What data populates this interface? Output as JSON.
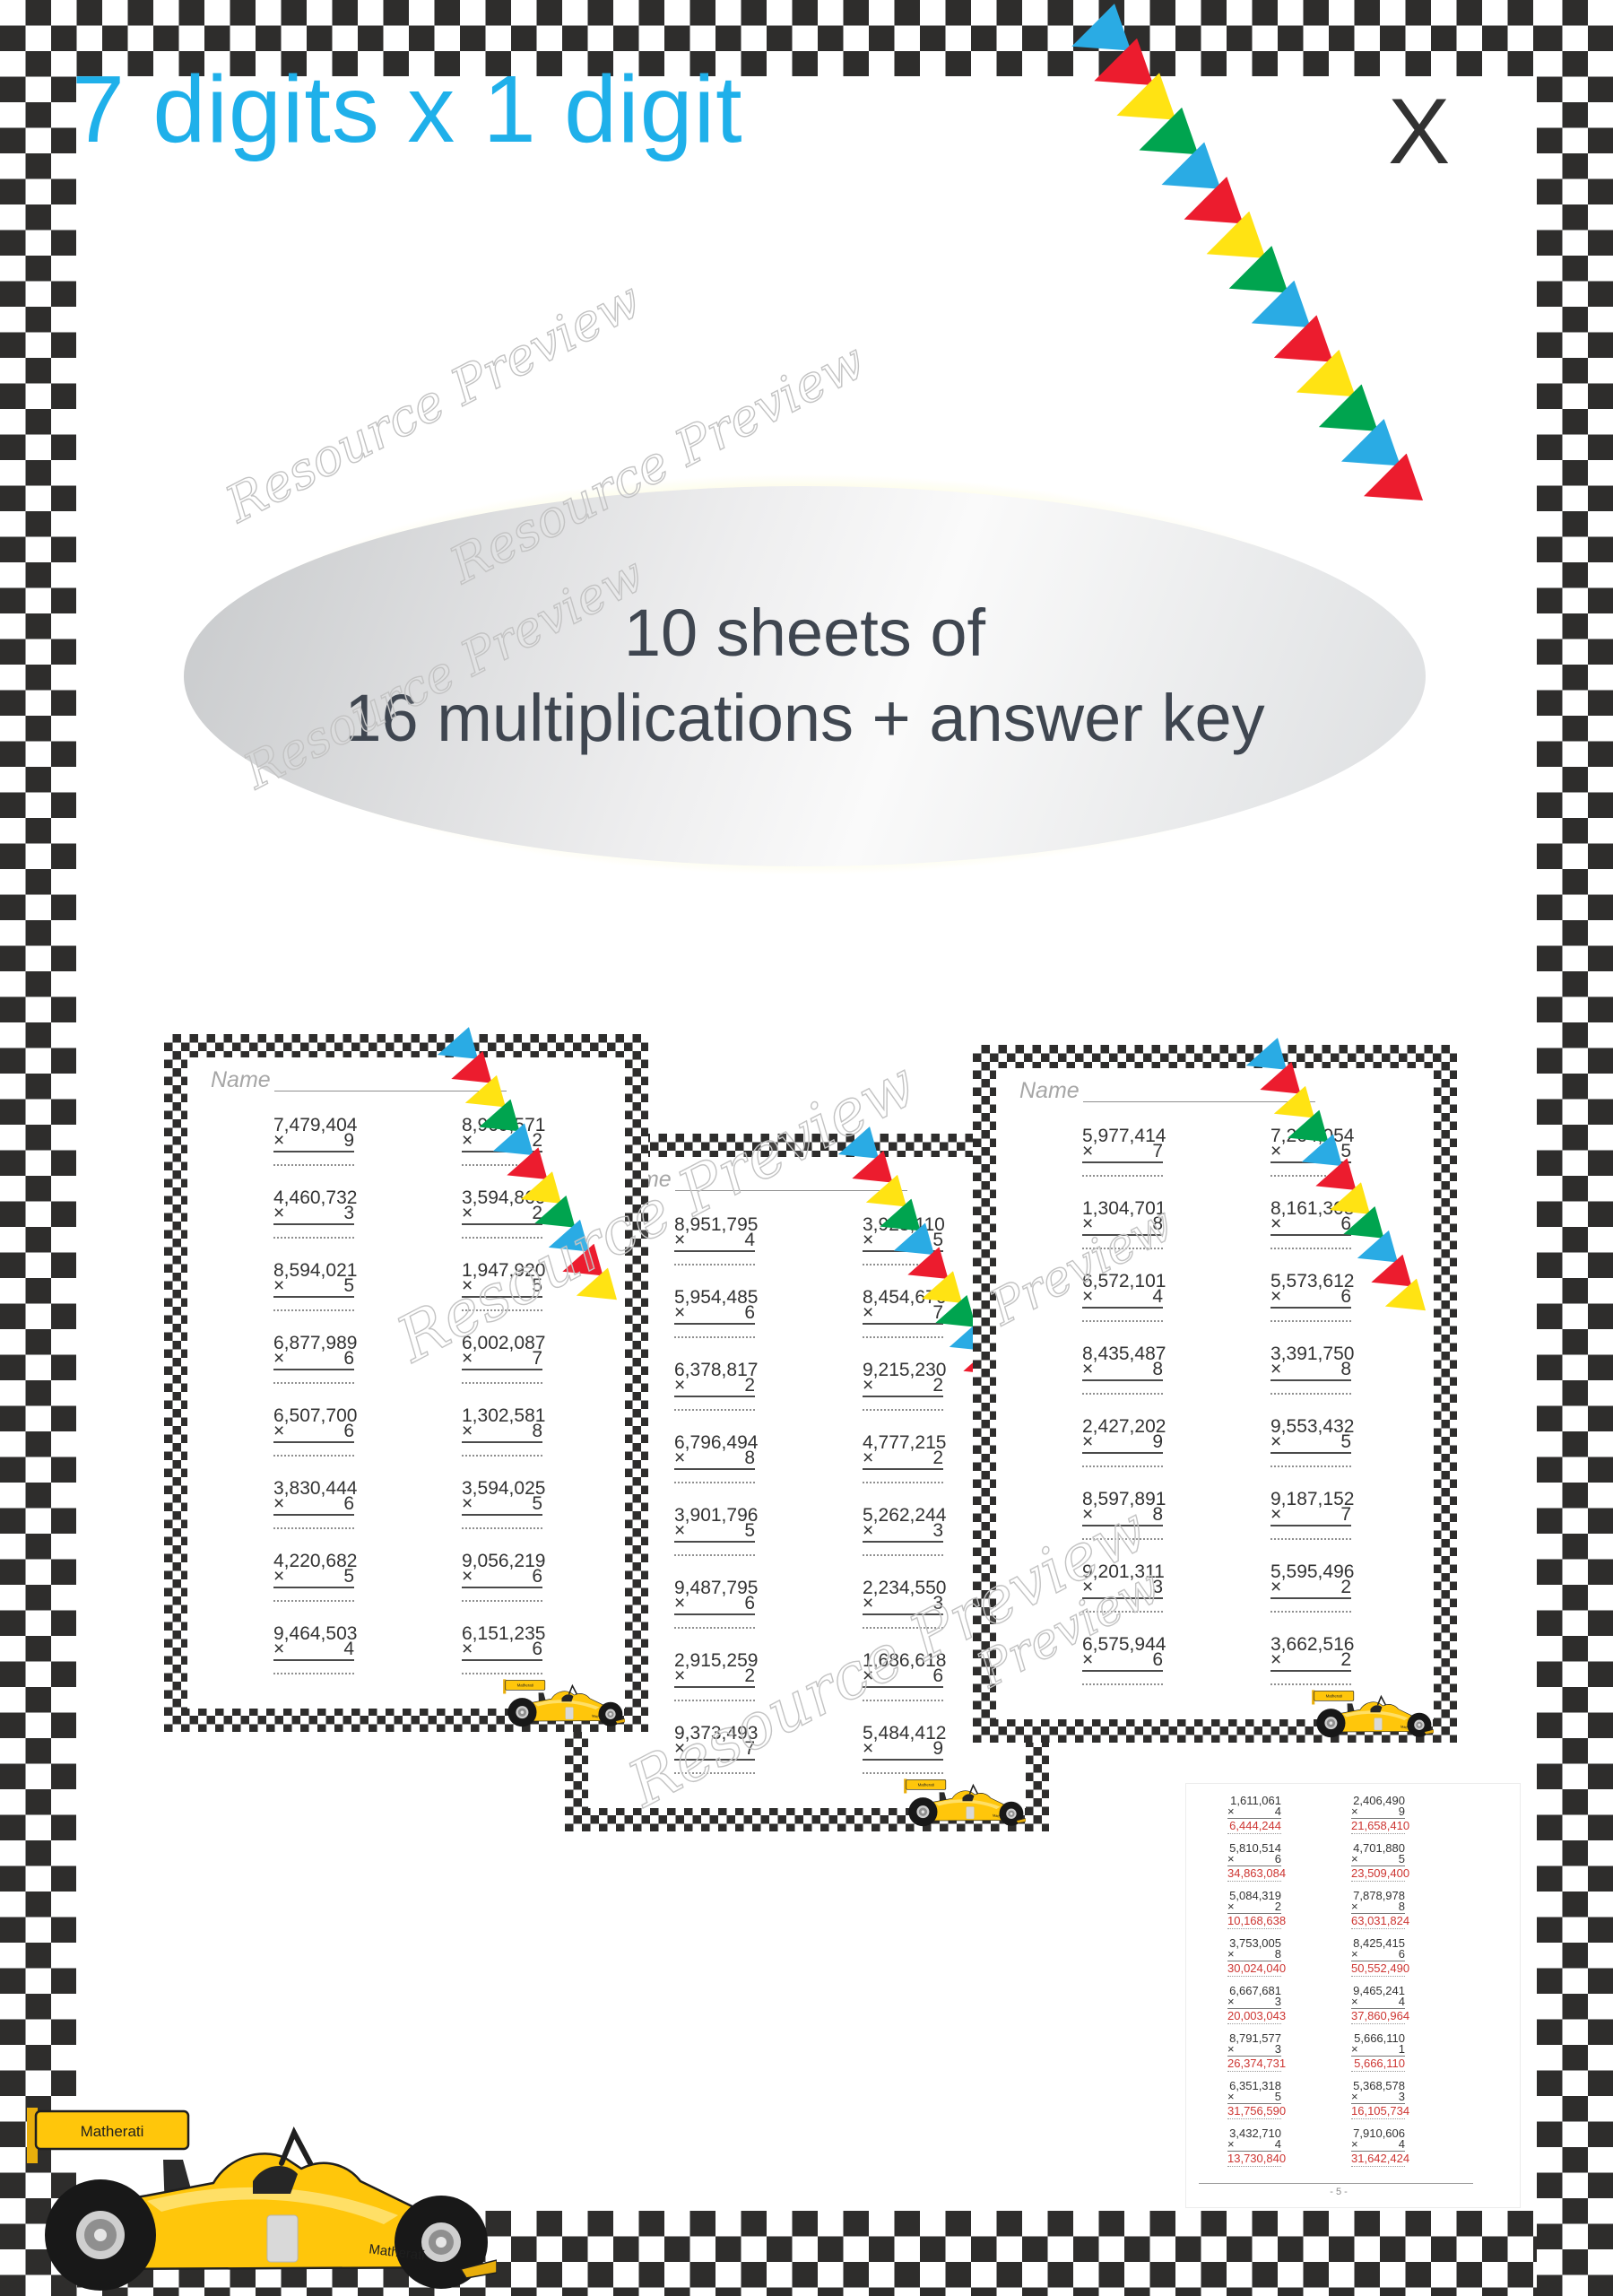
{
  "page": {
    "title": "7 digits x 1 digit",
    "corner_letter": "X",
    "badge": {
      "line1": "10 sheets of",
      "line2": "16 multiplications + answer key"
    },
    "watermark": "Resource Preview",
    "watermark_short": "Preview",
    "name_label": "Name",
    "brand": "Matherati",
    "multiply_sign": "×"
  },
  "colors": {
    "accent_cyan": "#1fb0ea",
    "checker_dark": "#2e2d2c",
    "answer_red": "#cd3531",
    "glow_yellow": "#f5ec66",
    "car_yellow": "#ffc60b",
    "flag_colors": [
      "#2aabe4",
      "#ec1c2e",
      "#ffe313",
      "#00a44f"
    ]
  },
  "sheets": [
    {
      "problems": [
        {
          "n": "7,479,404",
          "m": "9"
        },
        {
          "n": "8,969,571",
          "m": "2"
        },
        {
          "n": "4,460,732",
          "m": "3"
        },
        {
          "n": "3,594,860",
          "m": "2"
        },
        {
          "n": "8,594,021",
          "m": "5"
        },
        {
          "n": "1,947,920",
          "m": "5"
        },
        {
          "n": "6,877,989",
          "m": "6"
        },
        {
          "n": "6,002,087",
          "m": "7"
        },
        {
          "n": "6,507,700",
          "m": "6"
        },
        {
          "n": "1,302,581",
          "m": "8"
        },
        {
          "n": "3,830,444",
          "m": "6"
        },
        {
          "n": "3,594,025",
          "m": "5"
        },
        {
          "n": "4,220,682",
          "m": "5"
        },
        {
          "n": "9,056,219",
          "m": "6"
        },
        {
          "n": "9,464,503",
          "m": "4"
        },
        {
          "n": "6,151,235",
          "m": "6"
        }
      ]
    },
    {
      "problems": [
        {
          "n": "8,951,795",
          "m": "4"
        },
        {
          "n": "3,923,110",
          "m": "5"
        },
        {
          "n": "5,954,485",
          "m": "6"
        },
        {
          "n": "8,454,676",
          "m": "7"
        },
        {
          "n": "6,378,817",
          "m": "2"
        },
        {
          "n": "9,215,230",
          "m": "2"
        },
        {
          "n": "6,796,494",
          "m": "8"
        },
        {
          "n": "4,777,215",
          "m": "2"
        },
        {
          "n": "3,901,796",
          "m": "5"
        },
        {
          "n": "5,262,244",
          "m": "3"
        },
        {
          "n": "9,487,795",
          "m": "6"
        },
        {
          "n": "2,234,550",
          "m": "3"
        },
        {
          "n": "2,915,259",
          "m": "2"
        },
        {
          "n": "1,686,618",
          "m": "6"
        },
        {
          "n": "9,373,493",
          "m": "7"
        },
        {
          "n": "5,484,412",
          "m": "9"
        }
      ]
    },
    {
      "problems": [
        {
          "n": "5,977,414",
          "m": "7"
        },
        {
          "n": "7,264,054",
          "m": "5"
        },
        {
          "n": "1,304,701",
          "m": "8"
        },
        {
          "n": "8,161,308",
          "m": "6"
        },
        {
          "n": "6,572,101",
          "m": "4"
        },
        {
          "n": "5,573,612",
          "m": "6"
        },
        {
          "n": "8,435,487",
          "m": "8"
        },
        {
          "n": "3,391,750",
          "m": "8"
        },
        {
          "n": "2,427,202",
          "m": "9"
        },
        {
          "n": "9,553,432",
          "m": "5"
        },
        {
          "n": "8,597,891",
          "m": "8"
        },
        {
          "n": "9,187,152",
          "m": "7"
        },
        {
          "n": "9,201,311",
          "m": "3"
        },
        {
          "n": "5,595,496",
          "m": "2"
        },
        {
          "n": "6,575,944",
          "m": "6"
        },
        {
          "n": "3,662,516",
          "m": "2"
        }
      ]
    }
  ],
  "answer_key": {
    "page_number": "- 5 -",
    "problems": [
      {
        "n": "1,611,061",
        "m": "4",
        "a": "6,444,244"
      },
      {
        "n": "2,406,490",
        "m": "9",
        "a": "21,658,410"
      },
      {
        "n": "5,810,514",
        "m": "6",
        "a": "34,863,084"
      },
      {
        "n": "4,701,880",
        "m": "5",
        "a": "23,509,400"
      },
      {
        "n": "5,084,319",
        "m": "2",
        "a": "10,168,638"
      },
      {
        "n": "7,878,978",
        "m": "8",
        "a": "63,031,824"
      },
      {
        "n": "3,753,005",
        "m": "8",
        "a": "30,024,040"
      },
      {
        "n": "8,425,415",
        "m": "6",
        "a": "50,552,490"
      },
      {
        "n": "6,667,681",
        "m": "3",
        "a": "20,003,043"
      },
      {
        "n": "9,465,241",
        "m": "4",
        "a": "37,860,964"
      },
      {
        "n": "8,791,577",
        "m": "3",
        "a": "26,374,731"
      },
      {
        "n": "5,666,110",
        "m": "1",
        "a": "5,666,110"
      },
      {
        "n": "6,351,318",
        "m": "5",
        "a": "31,756,590"
      },
      {
        "n": "5,368,578",
        "m": "3",
        "a": "16,105,734"
      },
      {
        "n": "3,432,710",
        "m": "4",
        "a": "13,730,840"
      },
      {
        "n": "7,910,606",
        "m": "4",
        "a": "31,642,424"
      }
    ]
  }
}
